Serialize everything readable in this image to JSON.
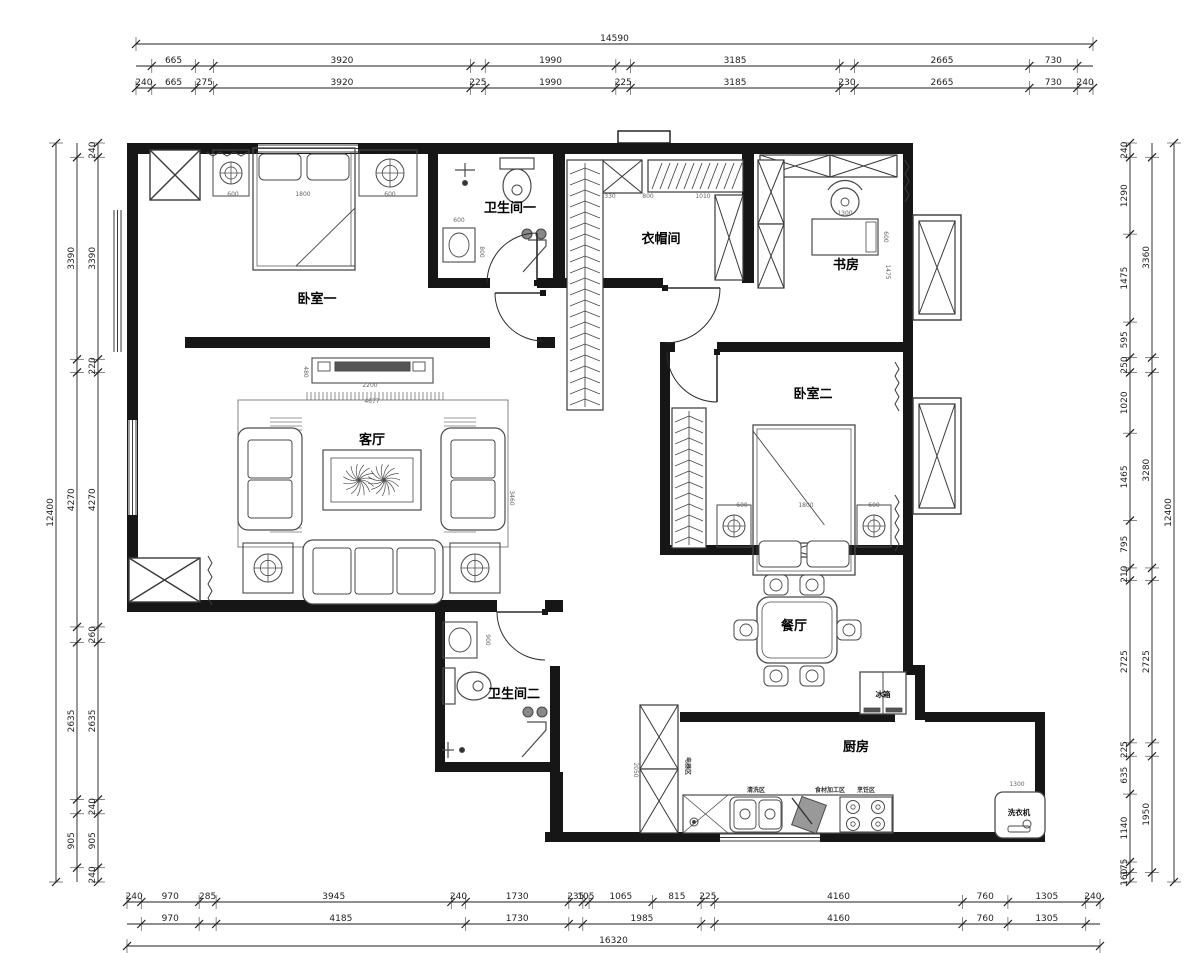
{
  "drawing": {
    "type": "apartment floor plan (CAD style)",
    "units": "mm"
  },
  "colors": {
    "wall": "#161616",
    "line": "#3a3a3a",
    "furniture": "#4a4a4a",
    "dim": "#1f1f1f",
    "ext": "#6a6a6a",
    "bg": "#ffffff"
  },
  "rooms": [
    {
      "id": "bedroom1",
      "label": "卧室一",
      "x": 317,
      "y": 303
    },
    {
      "id": "bath1",
      "label": "卫生间一",
      "x": 510,
      "y": 212
    },
    {
      "id": "cloakroom",
      "label": "衣帽间",
      "x": 661,
      "y": 243
    },
    {
      "id": "study",
      "label": "书房",
      "x": 846,
      "y": 269
    },
    {
      "id": "living",
      "label": "客厅",
      "x": 372,
      "y": 444
    },
    {
      "id": "bedroom2",
      "label": "卧室二",
      "x": 813,
      "y": 398
    },
    {
      "id": "dining",
      "label": "餐厅",
      "x": 794,
      "y": 630
    },
    {
      "id": "bath2",
      "label": "卫生间二",
      "x": 514,
      "y": 698
    },
    {
      "id": "kitchen",
      "label": "厨房",
      "x": 856,
      "y": 751
    }
  ],
  "appliance_labels": [
    {
      "id": "fridge",
      "text": "冰箱",
      "x": 883,
      "y": 697
    },
    {
      "id": "washing-machine",
      "text": "洗衣机",
      "x": 1019,
      "y": 815
    }
  ],
  "kitchen_zone_labels": [
    {
      "t": "电器区",
      "x": 686,
      "y": 766,
      "r": 90
    },
    {
      "t": "清洗区",
      "x": 756,
      "y": 792,
      "r": 0
    },
    {
      "t": "食材加工区",
      "x": 830,
      "y": 792,
      "r": 0
    },
    {
      "t": "烹饪区",
      "x": 866,
      "y": 792,
      "r": 0
    }
  ],
  "small_dims": [
    {
      "t": "600",
      "x": 233,
      "y": 196,
      "r": 0
    },
    {
      "t": "1800",
      "x": 303,
      "y": 196,
      "r": 0
    },
    {
      "t": "600",
      "x": 390,
      "y": 196,
      "r": 0
    },
    {
      "t": "600",
      "x": 459,
      "y": 222,
      "r": 0
    },
    {
      "t": "800",
      "x": 480,
      "y": 252,
      "r": 90
    },
    {
      "t": "330",
      "x": 610,
      "y": 198,
      "r": 0
    },
    {
      "t": "800",
      "x": 648,
      "y": 198,
      "r": 0
    },
    {
      "t": "1010",
      "x": 703,
      "y": 198,
      "r": 0
    },
    {
      "t": "1300",
      "x": 845,
      "y": 215,
      "r": 0
    },
    {
      "t": "600",
      "x": 884,
      "y": 237,
      "r": 90
    },
    {
      "t": "1475",
      "x": 886,
      "y": 272,
      "r": 90
    },
    {
      "t": "480",
      "x": 304,
      "y": 372,
      "r": 90
    },
    {
      "t": "2200",
      "x": 370,
      "y": 387,
      "r": 0
    },
    {
      "t": "4677",
      "x": 372,
      "y": 403,
      "r": 0
    },
    {
      "t": "3460",
      "x": 510,
      "y": 498,
      "r": 90
    },
    {
      "t": "600",
      "x": 742,
      "y": 507,
      "r": 0
    },
    {
      "t": "1800",
      "x": 806,
      "y": 507,
      "r": 0
    },
    {
      "t": "600",
      "x": 874,
      "y": 507,
      "r": 0
    },
    {
      "t": "900",
      "x": 486,
      "y": 640,
      "r": 90
    },
    {
      "t": "2050",
      "x": 634,
      "y": 770,
      "r": 90
    },
    {
      "t": "1300",
      "x": 1017,
      "y": 786,
      "r": 0
    }
  ],
  "dimensions": {
    "top": {
      "total": "14590",
      "inner": [
        "240",
        "665",
        "275",
        "3920",
        "225",
        "1990",
        "225",
        "3185",
        "230",
        "2665",
        "730",
        "240"
      ],
      "middle": [
        {
          "v": "665",
          "a": 1,
          "b": 2
        },
        {
          "v": "3920",
          "a": 3,
          "b": 4
        },
        {
          "v": "1990",
          "a": 5,
          "b": 6
        },
        {
          "v": "3185",
          "a": 7,
          "b": 8
        },
        {
          "v": "2665",
          "a": 9,
          "b": 10
        },
        {
          "v": "730",
          "a": 10,
          "b": 11
        }
      ]
    },
    "bottom": {
      "total": "16320",
      "inner": [
        "240",
        "970",
        "285",
        "3945",
        "240",
        "1730",
        "235",
        "105",
        "1065",
        "815",
        "225",
        "4160",
        "760",
        "1305",
        "240"
      ],
      "middle": [
        {
          "v": "970",
          "a": 1,
          "b": 2
        },
        {
          "v": "4185",
          "a": 3,
          "b": 5
        },
        {
          "v": "1730",
          "a": 5,
          "b": 6
        },
        {
          "v": "1985",
          "a": 7,
          "b": 10
        },
        {
          "v": "4160",
          "a": 11,
          "b": 12
        },
        {
          "v": "760",
          "a": 12,
          "b": 13
        },
        {
          "v": "1305",
          "a": 13,
          "b": 14
        }
      ]
    },
    "left": {
      "total": "12400",
      "inner": [
        "240",
        "3390",
        "220",
        "4270",
        "260",
        "2635",
        "240",
        "905",
        "240"
      ],
      "middle": [
        {
          "v": "3390",
          "a": 1,
          "b": 2
        },
        {
          "v": "4270",
          "a": 3,
          "b": 4
        },
        {
          "v": "2635",
          "a": 5,
          "b": 6
        },
        {
          "v": "905",
          "a": 7,
          "b": 8
        }
      ]
    },
    "right": {
      "total": "12400",
      "inner": [
        "240",
        "1290",
        "1475",
        "595",
        "250",
        "1020",
        "1465",
        "795",
        "210",
        "2725",
        "225",
        "635",
        "1140",
        "175",
        "160"
      ],
      "middle": [
        {
          "v": "3360",
          "a": 1,
          "b": 4
        },
        {
          "v": "3280",
          "a": 5,
          "b": 8
        },
        {
          "v": "2725",
          "a": 9,
          "b": 10
        },
        {
          "v": "1950",
          "a": 11,
          "b": 14
        }
      ]
    }
  }
}
